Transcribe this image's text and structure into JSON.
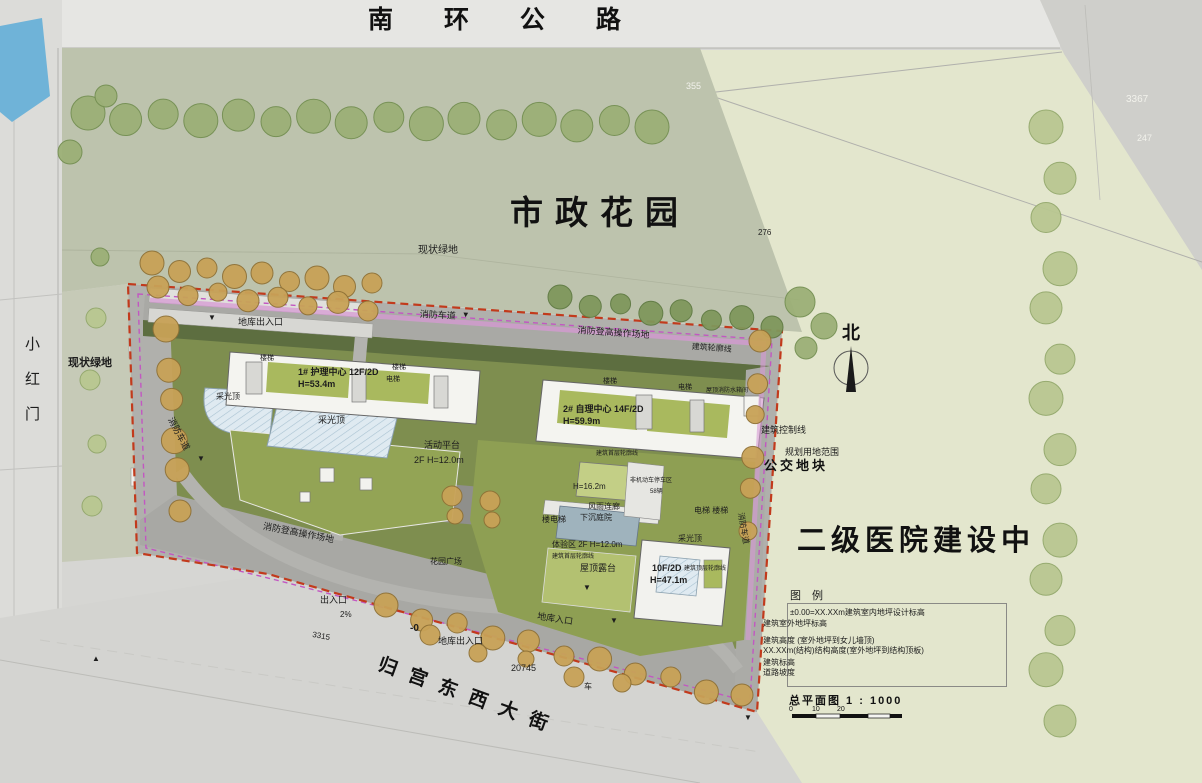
{
  "roads": {
    "north_road": "南 环 公 路",
    "west_road_vertical": "小红门",
    "south_street": "归宫东西大街"
  },
  "areas": {
    "garden": "市政花园",
    "hospital": "二级医院建设中",
    "bus_plot": "公交地块"
  },
  "compass": {
    "north": "北"
  },
  "legend": {
    "title": "图 例",
    "items": [
      "±0.00=XX.XXm建筑室内地坪设计标高",
      "建筑室外地坪标高",
      "建筑高度 (室外地坪到女儿墙顶)",
      "XX.XXm(结构)结构高度(室外地坪到结构顶板)",
      "建筑标高",
      "道路坡度"
    ],
    "scale_title": "总平面图 1 : 1000",
    "scale_ticks": [
      "0",
      "10",
      "20"
    ]
  },
  "annotations": [
    {
      "name": "existing-green-label-top",
      "text": "现状绿地",
      "x": 418,
      "y": 246,
      "s": 10
    },
    {
      "name": "garage-exit-label-nw",
      "text": "地库出入口",
      "x": 238,
      "y": 318,
      "s": 9
    },
    {
      "name": "fire-lane-label-top",
      "text": "消防车道",
      "x": 420,
      "y": 310,
      "s": 9,
      "r": 3
    },
    {
      "name": "road-direction-marker",
      "text": "▼",
      "x": 462,
      "y": 311,
      "s": 8,
      "r": 3
    },
    {
      "name": "fire-hoist-area-label-top",
      "text": "消防登高操作场地",
      "x": 578,
      "y": 326,
      "s": 9,
      "r": 4
    },
    {
      "name": "building-outline-label-top",
      "text": "建筑轮廓线",
      "x": 692,
      "y": 343,
      "s": 8,
      "r": 4
    },
    {
      "name": "stair-label-b1-west",
      "text": "楼梯",
      "x": 260,
      "y": 355,
      "s": 7
    },
    {
      "name": "building-1-label",
      "text": "1# 护理中心 12F/2D",
      "x": 298,
      "y": 368,
      "s": 9,
      "b": true
    },
    {
      "name": "building-1-height",
      "text": "H=53.4m",
      "x": 298,
      "y": 380,
      "s": 9,
      "b": true
    },
    {
      "name": "stair-label-b1-east",
      "text": "楼梯",
      "x": 392,
      "y": 364,
      "s": 7
    },
    {
      "name": "elevator-label-b1",
      "text": "电梯",
      "x": 386,
      "y": 376,
      "s": 7
    },
    {
      "name": "skylight-label-west",
      "text": "采光顶",
      "x": 216,
      "y": 393,
      "s": 8
    },
    {
      "name": "skylight-label-center",
      "text": "采光顶",
      "x": 318,
      "y": 416,
      "s": 9
    },
    {
      "name": "stair-label-b2-west",
      "text": "楼梯",
      "x": 603,
      "y": 378,
      "s": 7
    },
    {
      "name": "elevator-label-b2",
      "text": "电梯",
      "x": 678,
      "y": 384,
      "s": 7
    },
    {
      "name": "roof-fire-tank-label",
      "text": "屋顶消防水箱间",
      "x": 706,
      "y": 388,
      "s": 6
    },
    {
      "name": "building-2-label",
      "text": "2# 自理中心 14F/2D",
      "x": 563,
      "y": 405,
      "s": 9,
      "b": true
    },
    {
      "name": "building-2-height",
      "text": "H=59.9m",
      "x": 563,
      "y": 417,
      "s": 9,
      "b": true
    },
    {
      "name": "activity-platform-label",
      "text": "活动平台",
      "x": 424,
      "y": 441,
      "s": 9
    },
    {
      "name": "activity-platform-height",
      "text": "2F H=12.0m",
      "x": 414,
      "y": 456,
      "s": 9
    },
    {
      "name": "first-floor-outline-label-a",
      "text": "建筑首层轮廓线",
      "x": 596,
      "y": 451,
      "s": 6
    },
    {
      "name": "podium-height-label",
      "text": "H=16.2m",
      "x": 573,
      "y": 483,
      "s": 8
    },
    {
      "name": "bike-parking-label",
      "text": "非机动车停车区",
      "x": 630,
      "y": 478,
      "s": 6
    },
    {
      "name": "bike-parking-count",
      "text": "58辆",
      "x": 650,
      "y": 489,
      "s": 6
    },
    {
      "name": "covered-corridor-label",
      "text": "风雨连廊",
      "x": 588,
      "y": 503,
      "s": 8
    },
    {
      "name": "stair-elevator-label",
      "text": "楼电梯",
      "x": 542,
      "y": 516,
      "s": 8
    },
    {
      "name": "sunken-courtyard-label",
      "text": "下沉庭院",
      "x": 580,
      "y": 514,
      "s": 8
    },
    {
      "name": "elevator-stair-label-east",
      "text": "电梯  楼梯",
      "x": 694,
      "y": 507,
      "s": 8
    },
    {
      "name": "experience-zone-label",
      "text": "体验区 2F H=12.0m",
      "x": 552,
      "y": 541,
      "s": 8
    },
    {
      "name": "first-floor-outline-label-b",
      "text": "建筑首层轮廓线",
      "x": 552,
      "y": 554,
      "s": 6
    },
    {
      "name": "roof-terrace-label",
      "text": "屋顶露台",
      "x": 580,
      "y": 564,
      "s": 9
    },
    {
      "name": "skylight-label-east",
      "text": "采光顶",
      "x": 678,
      "y": 535,
      "s": 8
    },
    {
      "name": "building-3-label",
      "text": "10F/2D",
      "x": 652,
      "y": 564,
      "s": 9,
      "b": true
    },
    {
      "name": "building-3-height",
      "text": "H=47.1m",
      "x": 650,
      "y": 576,
      "s": 9,
      "b": true
    },
    {
      "name": "top-floor-outline-label",
      "text": "建筑顶层轮廓线",
      "x": 684,
      "y": 566,
      "s": 6
    },
    {
      "name": "fire-lane-label-west",
      "text": "消防车道",
      "x": 174,
      "y": 416,
      "s": 9,
      "r": 62
    },
    {
      "name": "fire-hoist-area-label-south",
      "text": "消防登高操作场地",
      "x": 264,
      "y": 522,
      "s": 9,
      "r": 11
    },
    {
      "name": "fire-lane-label-east",
      "text": "消防车道",
      "x": 744,
      "y": 512,
      "s": 8,
      "r": 80
    },
    {
      "name": "building-control-line-label",
      "text": "建筑控制线",
      "x": 761,
      "y": 426,
      "s": 9
    },
    {
      "name": "planning-boundary-label",
      "text": "规划用地范围",
      "x": 785,
      "y": 448,
      "s": 9
    },
    {
      "name": "garden-plaza-label",
      "text": "花园广场",
      "x": 430,
      "y": 558,
      "s": 8
    },
    {
      "name": "garage-entrance-label-south",
      "text": "地库入口",
      "x": 538,
      "y": 612,
      "s": 9,
      "r": 9
    },
    {
      "name": "entrance-label-sw",
      "text": "出入口",
      "x": 320,
      "y": 596,
      "s": 9
    },
    {
      "name": "slope-label",
      "text": "2%",
      "x": 340,
      "y": 611,
      "s": 8
    },
    {
      "name": "level-label",
      "text": "-0",
      "x": 410,
      "y": 624,
      "s": 10,
      "b": true
    },
    {
      "name": "garage-entrance-label-s2",
      "text": "地库出入口",
      "x": 438,
      "y": 637,
      "s": 9
    },
    {
      "name": "dim-20745",
      "text": "20745",
      "x": 511,
      "y": 664,
      "s": 9
    },
    {
      "name": "dim-3315",
      "text": "3315",
      "x": 313,
      "y": 631,
      "s": 8,
      "r": 10
    },
    {
      "name": "vehicle-label",
      "text": "车",
      "x": 584,
      "y": 683,
      "s": 8
    },
    {
      "name": "dim-355",
      "text": "355",
      "x": 686,
      "y": 82,
      "s": 9,
      "c": "#f2f2ec"
    },
    {
      "name": "dim-3367",
      "text": "3367",
      "x": 1126,
      "y": 95,
      "s": 10,
      "c": "#f2f2ec"
    },
    {
      "name": "dim-247",
      "text": "247",
      "x": 1137,
      "y": 134,
      "s": 9,
      "c": "#f2f2ec"
    },
    {
      "name": "dim-276",
      "text": "276",
      "x": 758,
      "y": 229,
      "s": 8
    },
    {
      "name": "existing-green-label-west",
      "text": "现状绿地",
      "x": 68,
      "y": 358,
      "s": 11,
      "b": true
    },
    {
      "name": "road-direction-marker",
      "text": "▼",
      "x": 208,
      "y": 314,
      "s": 8
    },
    {
      "name": "road-direction-marker",
      "text": "▼",
      "x": 197,
      "y": 455,
      "s": 8
    },
    {
      "name": "road-direction-marker",
      "text": "▼",
      "x": 583,
      "y": 584,
      "s": 8
    },
    {
      "name": "road-direction-marker",
      "text": "▼",
      "x": 610,
      "y": 617,
      "s": 8
    },
    {
      "name": "road-direction-marker",
      "text": "▼",
      "x": 744,
      "y": 714,
      "s": 8
    },
    {
      "name": "road-direction-marker",
      "text": "▲",
      "x": 92,
      "y": 655,
      "s": 8
    }
  ]
}
